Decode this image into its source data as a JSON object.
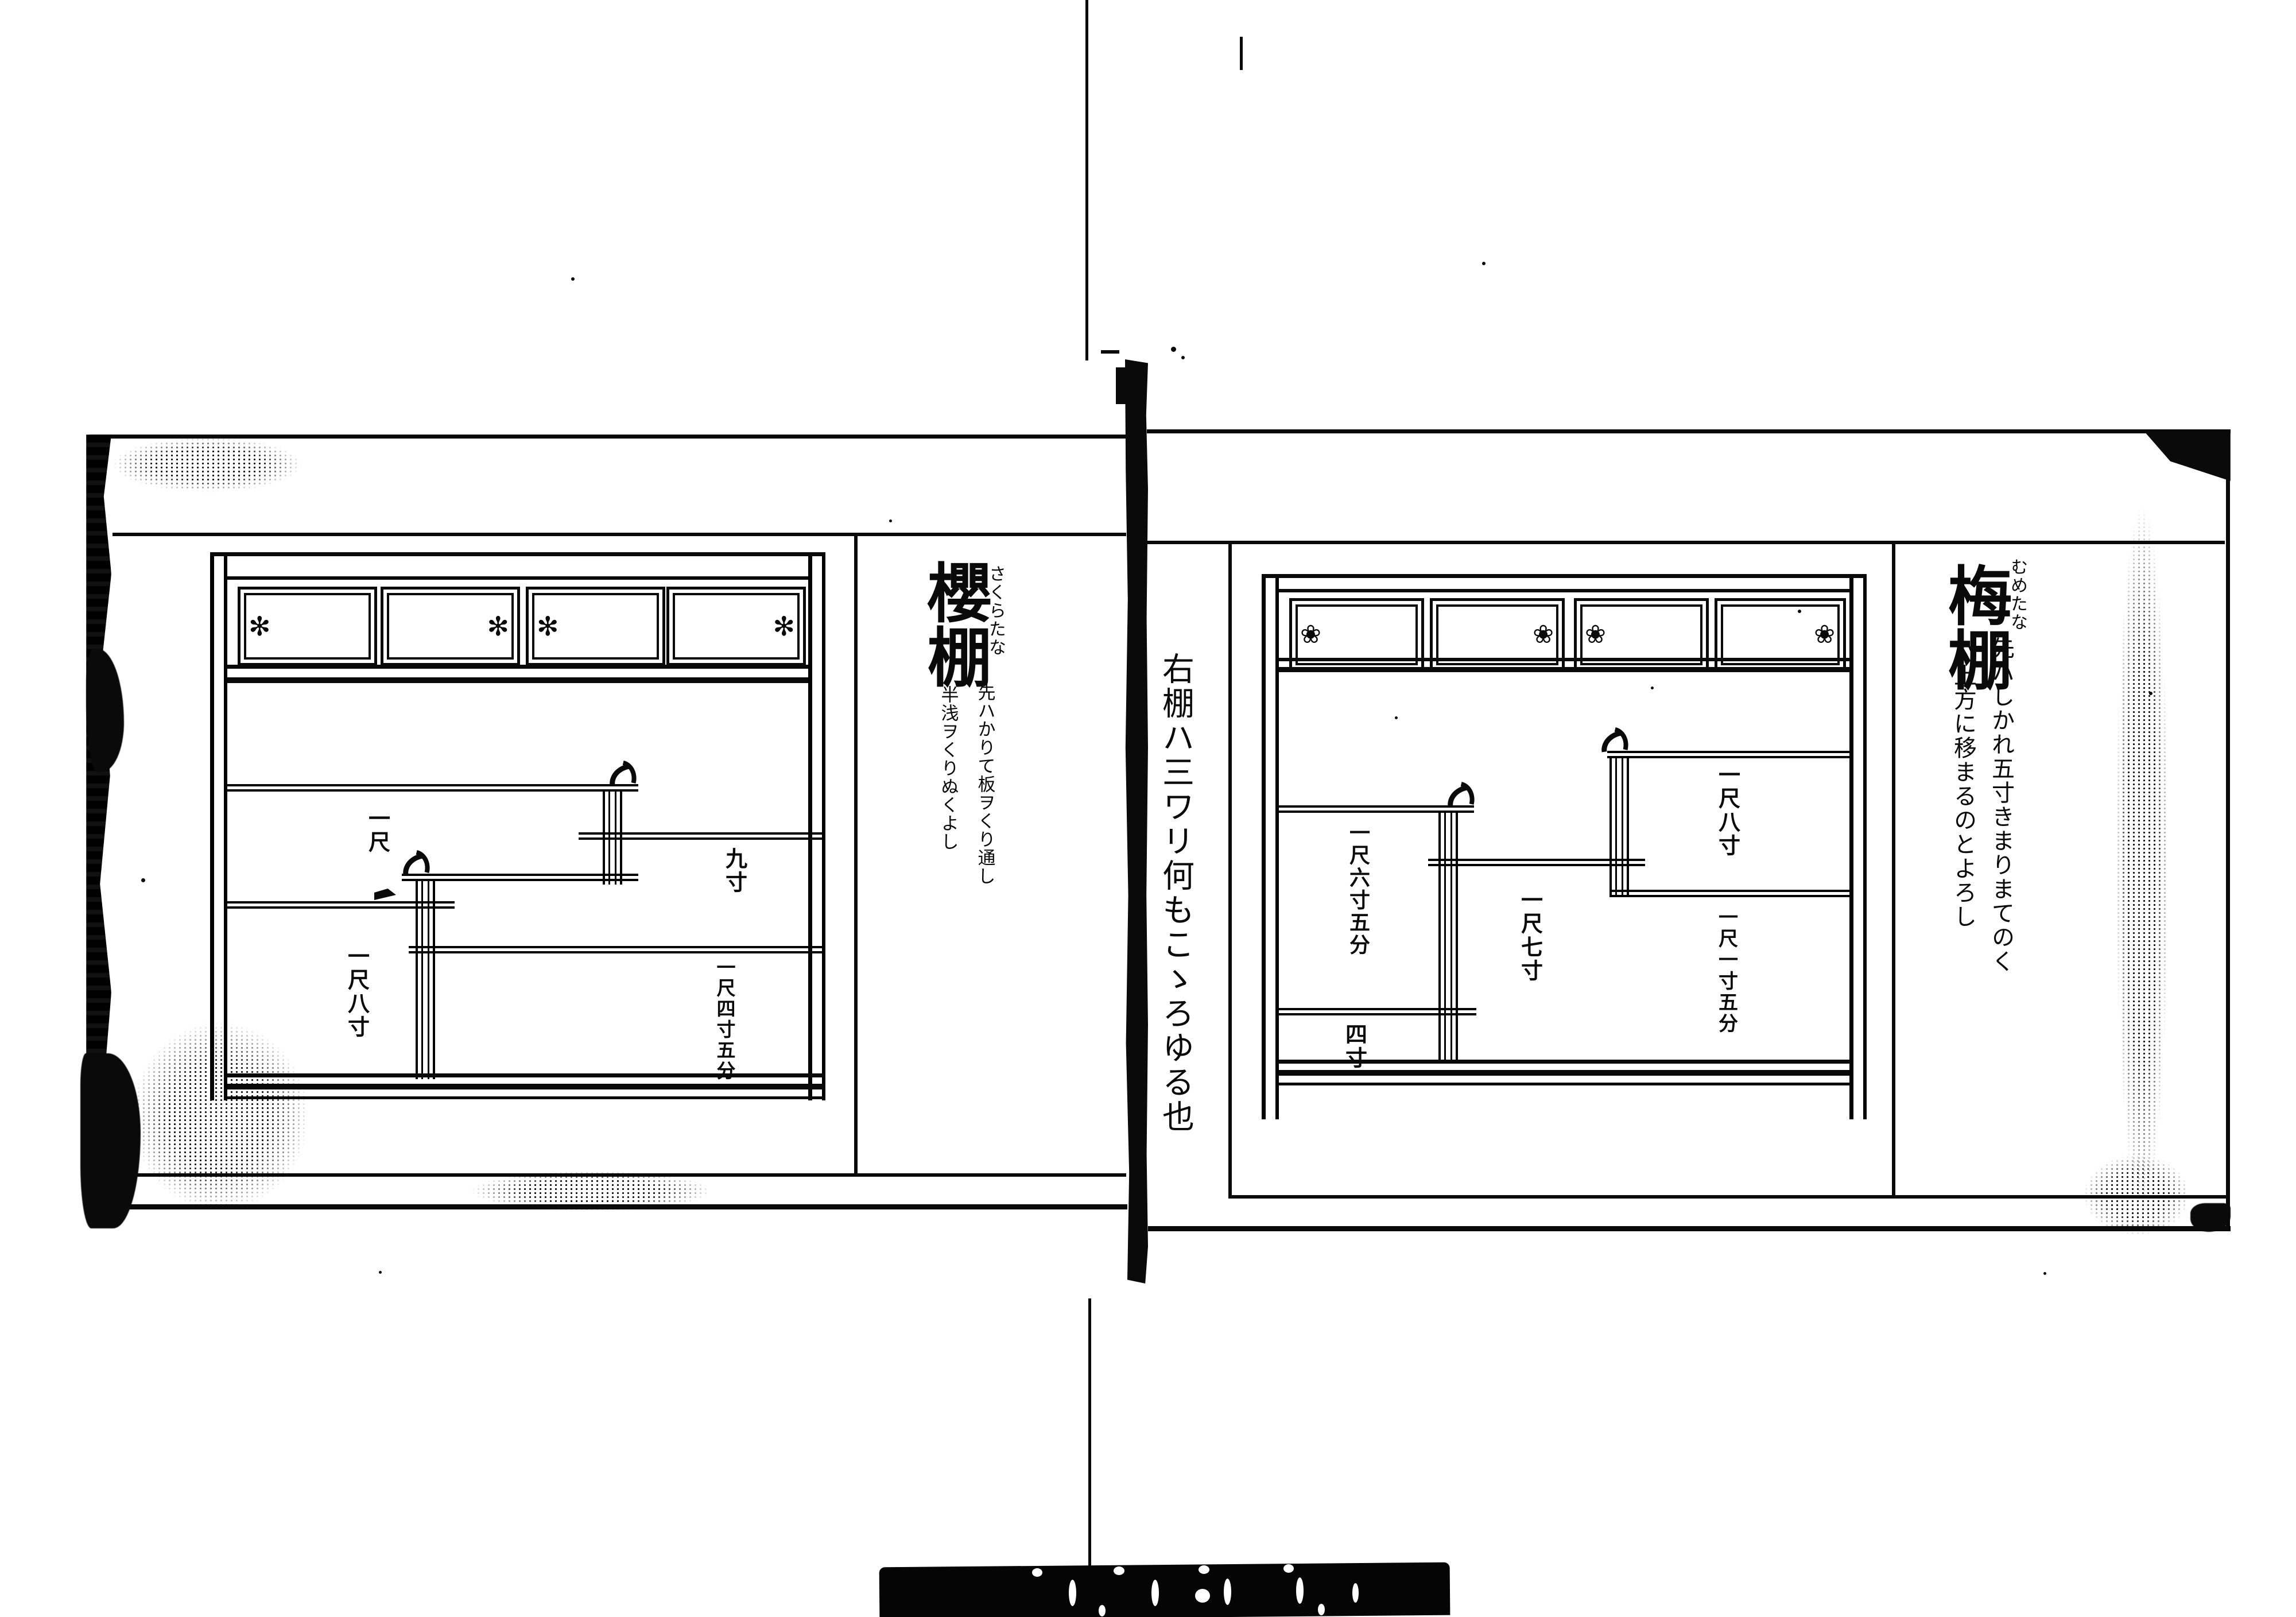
{
  "colors": {
    "ink": "#0a0a0a",
    "paper": "#ffffff"
  },
  "book": {
    "left_page": {
      "title": "櫻棚",
      "title_kana": "さくらたな",
      "note_a": "先ハかりて板ヲくり通し",
      "note_b": "半浅ヲくりぬくよし",
      "dims": {
        "upper_left": "一尺",
        "right_mid": "九寸",
        "lower_left": "一尺八寸",
        "lower_right": "一尺四寸五分"
      },
      "flower_icon": "✻"
    },
    "right_page": {
      "title": "梅棚",
      "title_kana": "むめたな",
      "margin_note": "右棚ハ三ワリ何もこゝろゆる也",
      "note_a": "先ハしかれ五寸きまりまてのく",
      "note_b": "ハ上方に移まるのとよろし",
      "dims": {
        "upper_right": "一尺八寸",
        "left_mid": "一尺六寸五分",
        "center": "一尺七寸",
        "lower_right": "一尺一寸五分",
        "bottom_left": "四寸"
      },
      "flower_icon": "❀"
    }
  }
}
